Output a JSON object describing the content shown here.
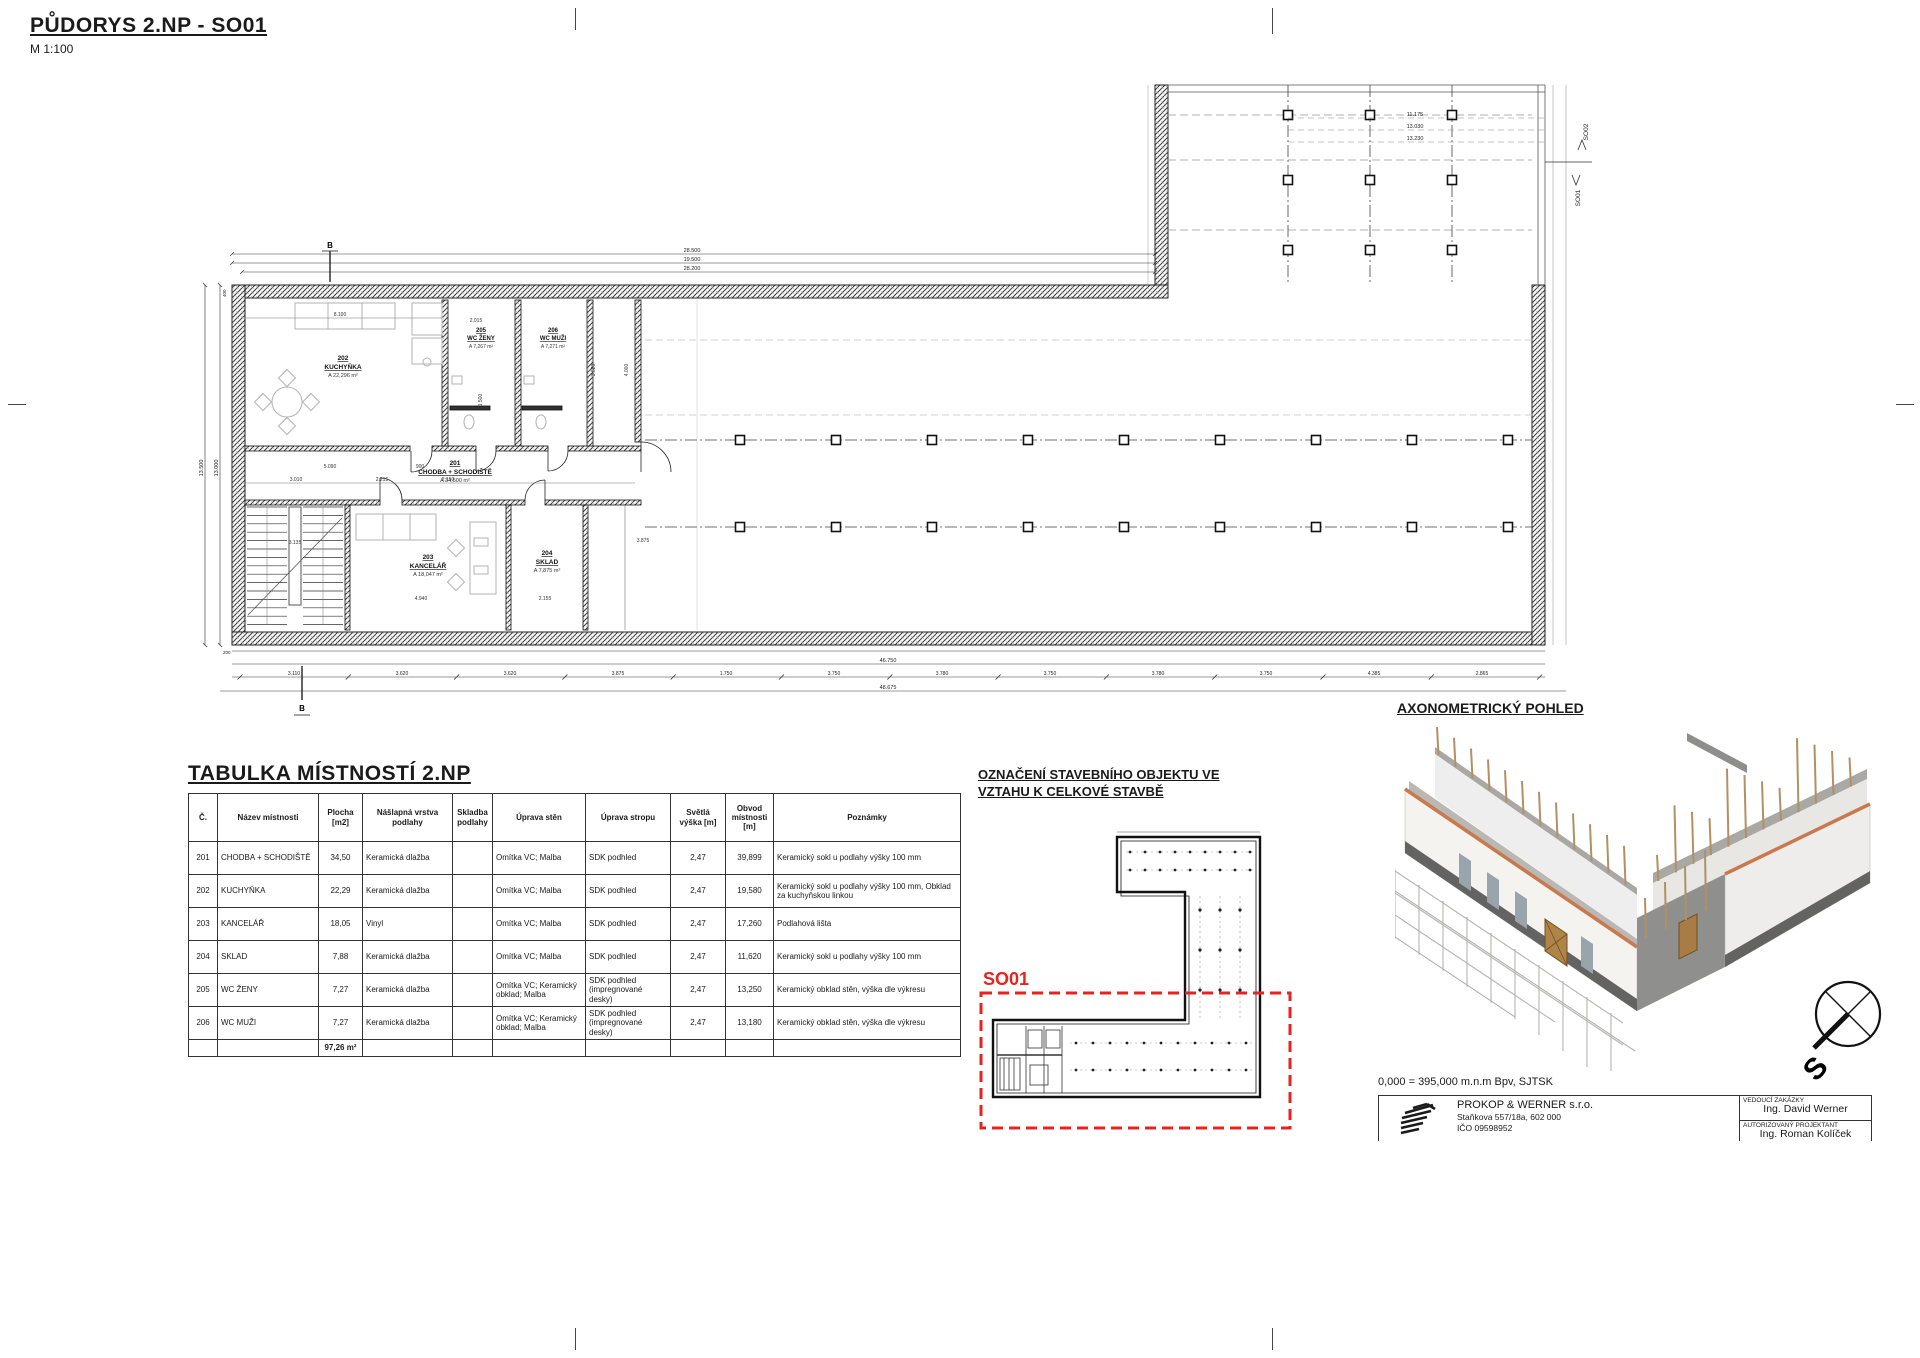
{
  "page": {
    "title": "PŮDORYS 2.NP - SO01",
    "scale": "M 1:100"
  },
  "plan": {
    "section_mark": "B",
    "boundary_labels": {
      "upper": "SO02",
      "lower": "SO01"
    },
    "rooms": [
      {
        "num": "202",
        "name": "KUCHYŇKA",
        "area": "A 22,296 m²"
      },
      {
        "num": "205",
        "name": "WC ŽENY",
        "area": "A 7,267 m²"
      },
      {
        "num": "206",
        "name": "WC MUŽI",
        "area": "A 7,271 m²"
      },
      {
        "num": "201",
        "name": "CHODBA + SCHODIŠTĚ",
        "area": "A 34,500 m²"
      },
      {
        "num": "203",
        "name": "KANCELÁŘ",
        "area": "A 18,047 m²"
      },
      {
        "num": "204",
        "name": "SKLAD",
        "area": "A 7,875 m²"
      }
    ],
    "dims": {
      "top": [
        "28.500",
        "19.500",
        "28.200"
      ],
      "upper_right": [
        "11.175",
        "13.030",
        "13.230"
      ],
      "left": [
        "13.500",
        "13.000"
      ],
      "left_small": "400",
      "bottom_small": "200",
      "bottom_total_a": "46.750",
      "bottom_total_b": "48.675",
      "bottom_segments": [
        "3.110",
        "3.620",
        "3.620",
        "3.875",
        "1.750",
        "3.750",
        "3.780",
        "3.750",
        "3.780",
        "3.750",
        "4.385",
        "2.865"
      ],
      "interior": {
        "kitchen_w": "8.100",
        "wc_zeny_w": "2.015",
        "room_d": "3.620",
        "hall_d": "4.000",
        "corridor_a": "5.090",
        "corridor_b": "3.010",
        "corridor_c": "2.215",
        "corridor_d": "2.150",
        "stair_w": "3.135",
        "office_w": "4.940",
        "sklad_w": "2.155",
        "hall_seg": "3.875",
        "wc_d": "1.500",
        "door_w": "900"
      }
    }
  },
  "table": {
    "title": "TABULKA MÍSTNOSTÍ 2.NP",
    "headers": [
      "Č.",
      "Název místnosti",
      "Plocha\n[m2]",
      "Nášlapná vrstva\npodlahy",
      "Skladba\npodlahy",
      "Úprava stěn",
      "Úprava stropu",
      "Světlá\nvýška [m]",
      "Obvod\nmístnosti\n[m]",
      "Poznámky"
    ],
    "rows": [
      {
        "num": "201",
        "name": "CHODBA + SCHODIŠTĚ",
        "area": "34,50",
        "floor": "Keramická dlažba",
        "skladba": "",
        "walls": "Omítka VC; Malba",
        "ceiling": "SDK podhled",
        "height": "2,47",
        "perimeter": "39,899",
        "note": "Keramický sokl u  podlahy výšky 100 mm"
      },
      {
        "num": "202",
        "name": "KUCHYŇKA",
        "area": "22,29",
        "floor": "Keramická dlažba",
        "skladba": "",
        "walls": "Omítka VC; Malba",
        "ceiling": "SDK podhled",
        "height": "2,47",
        "perimeter": "19,580",
        "note": "Keramický sokl u  podlahy výšky 100 mm, Obklad za kuchyňskou  linkou"
      },
      {
        "num": "203",
        "name": "KANCELÁŘ",
        "area": "18,05",
        "floor": "Vinyl",
        "skladba": "",
        "walls": "Omítka VC; Malba",
        "ceiling": "SDK podhled",
        "height": "2,47",
        "perimeter": "17,260",
        "note": "Podlahová lišta"
      },
      {
        "num": "204",
        "name": "SKLAD",
        "area": "7,88",
        "floor": "Keramická dlažba",
        "skladba": "",
        "walls": "Omítka VC; Malba",
        "ceiling": "SDK podhled",
        "height": "2,47",
        "perimeter": "11,620",
        "note": "Keramický sokl u  podlahy výšky 100 mm"
      },
      {
        "num": "205",
        "name": "WC ŽENY",
        "area": "7,27",
        "floor": "Keramická dlažba",
        "skladba": "",
        "walls": "Omítka VC; Keramický obklad; Malba",
        "ceiling": "SDK podhled (impregnované desky)",
        "height": "2,47",
        "perimeter": "13,250",
        "note": "Keramický obklad stěn,  výška dle výkresu"
      },
      {
        "num": "206",
        "name": "WC MUŽI",
        "area": "7,27",
        "floor": "Keramická dlažba",
        "skladba": "",
        "walls": "Omítka VC; Keramický obklad; Malba",
        "ceiling": "SDK podhled (impregnované desky)",
        "height": "2,47",
        "perimeter": "13,180",
        "note": "Keramický obklad stěn,  výška dle výkresu"
      }
    ],
    "total": "97,26 m²"
  },
  "location": {
    "heading_line1": "OZNAČENÍ STAVEBNÍHO OBJEKTU VE",
    "heading_line2": "VZTAHU K CELKOVÉ STAVBĚ",
    "so_label": "SO01"
  },
  "axon": {
    "heading": "AXONOMETRICKÝ POHLED",
    "level_note": "0,000 = 395,000 m.n.m Bpv, SJTSK",
    "compass_s": "S"
  },
  "titleblock": {
    "company": "PROKOP & WERNER s.r.o.",
    "address": "Staňkova 557/18a, 602 000",
    "ico": "IČO 09598952",
    "lead_label": "VEDOUCÍ ZAKÁZKY",
    "lead_value": "Ing. David Werner",
    "authorized_label": "AUTORIZOVANÝ PROJEKTANT",
    "authorized_value": "Ing. Roman Kolíček"
  },
  "colors": {
    "red": "#e8231f",
    "trim_orange": "#c9794e",
    "stud_brown": "#b29064"
  }
}
